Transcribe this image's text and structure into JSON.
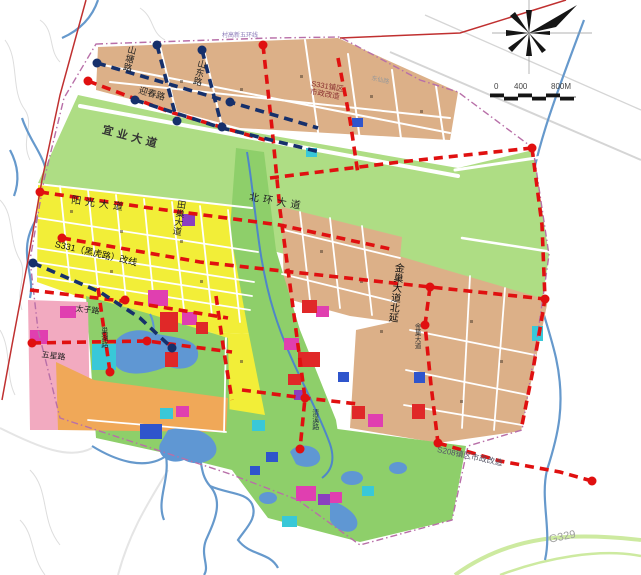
{
  "map": {
    "title_hint": "town land-use and road improvement planning map",
    "labels": {
      "cungao_line": "村高新五环线",
      "shantang_rd": "山塘路",
      "shandong_rd": "山东路",
      "yingchun_rd": "迎春路",
      "yiye_ave": "宜业大道",
      "s331_town_l1": "S331镇区",
      "s331_town_l2": "市政改造",
      "dongxian_rd": "东仙路",
      "beihuan_ave": "北环大道",
      "yangguang_ave": "阳光大道",
      "tianchao_ave": "田巢大道",
      "s331_reroute": "S331（黑虎路）改线",
      "taizi_rd": "太子路",
      "wuxing_rd": "五星路",
      "chaohu_rd": "巢湖路",
      "qingxi_rd": "清溪路",
      "jinchao_ext": "金巢大道北延",
      "jinchao_ave": "金巢大道",
      "s208_note": "S208镇区市政改造",
      "g329": "G329"
    },
    "scale": {
      "t0": "0",
      "t400": "400",
      "t800": "800M"
    },
    "colors": {
      "tan": "#dcb088",
      "green_band": "#aedd84",
      "green_park": "#8ecf6a",
      "yellow": "#f2ee38",
      "orange": "#f0a858",
      "pink": "#f2aac0",
      "magenta": "#e03fb0",
      "red_block": "#e02828",
      "blue_block": "#2f55cc",
      "cyan": "#39c8d8",
      "purple_block": "#8a3fc0",
      "red_dash": "#e01010",
      "navy_dash": "#16306b",
      "boundary": "#b86fa8",
      "river": "#6699cc",
      "existing_road": "#c03030",
      "rural_road": "#cdeaa0"
    }
  }
}
